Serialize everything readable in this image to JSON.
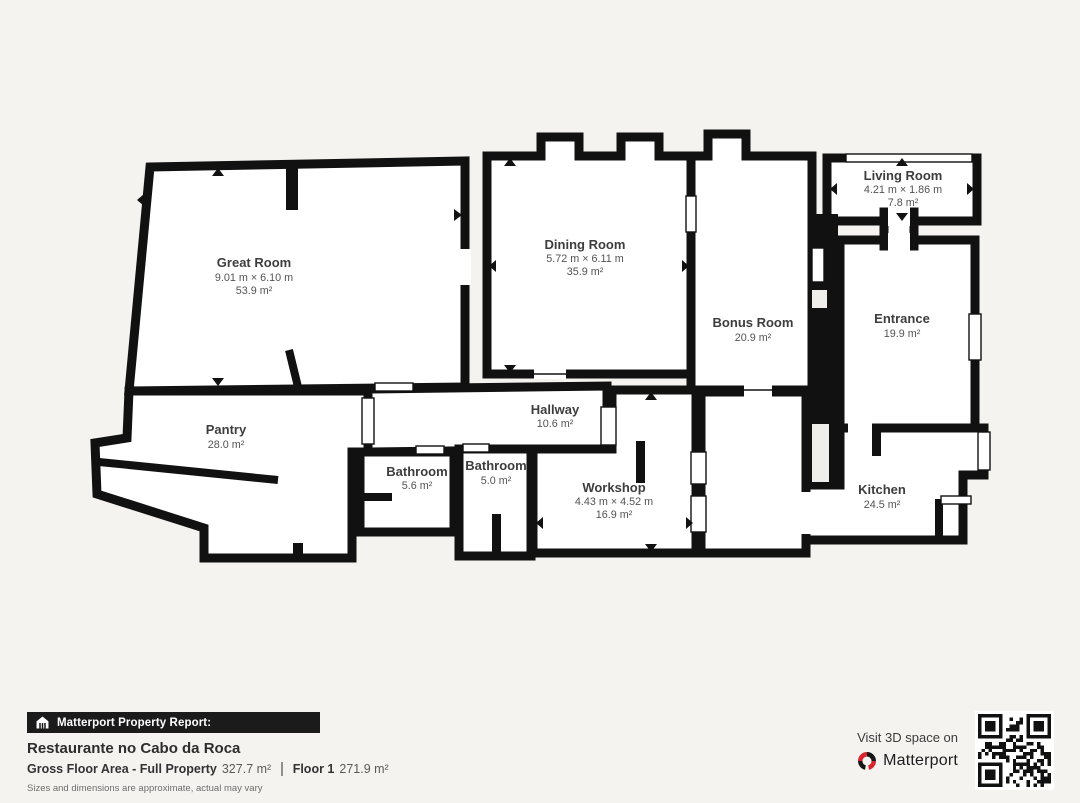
{
  "floorplan": {
    "rooms": [
      {
        "id": "great-room",
        "name": "Great Room",
        "dimensions": "9.01 m × 6.10 m",
        "area": "53.9 m²"
      },
      {
        "id": "dining-room",
        "name": "Dining Room",
        "dimensions": "5.72 m × 6.11 m",
        "area": "35.9 m²"
      },
      {
        "id": "living-room",
        "name": "Living Room",
        "dimensions": "4.21 m × 1.86 m",
        "area": "7.8 m²"
      },
      {
        "id": "bonus-room",
        "name": "Bonus Room",
        "area": "20.9 m²"
      },
      {
        "id": "entrance",
        "name": "Entrance",
        "area": "19.9 m²"
      },
      {
        "id": "pantry",
        "name": "Pantry",
        "area": "28.0 m²"
      },
      {
        "id": "hallway",
        "name": "Hallway",
        "area": "10.6 m²"
      },
      {
        "id": "bathroom-1",
        "name": "Bathroom",
        "area": "5.6 m²"
      },
      {
        "id": "bathroom-2",
        "name": "Bathroom",
        "area": "5.0 m²"
      },
      {
        "id": "workshop",
        "name": "Workshop",
        "dimensions": "4.43 m × 4.52 m",
        "area": "16.9 m²"
      },
      {
        "id": "kitchen",
        "name": "Kitchen",
        "area": "24.5 m²"
      }
    ]
  },
  "footer": {
    "report_label": "Matterport Property Report:",
    "property_name": "Restaurante no Cabo da Roca",
    "gross_label": "Gross Floor Area - Full Property",
    "gross_value": "327.7 m²",
    "floor_label": "Floor 1",
    "floor_value": "271.9 m²",
    "disclaimer": "Sizes and dimensions are approximate, actual may vary"
  },
  "cta": {
    "visit_text": "Visit 3D space on",
    "brand": "Matterport"
  },
  "colors": {
    "background": "#f4f3f0",
    "wall": "#111111",
    "room_fill": "#ffffff",
    "bar_background": "#1b1b1b",
    "brand_red": "#d9232e"
  }
}
